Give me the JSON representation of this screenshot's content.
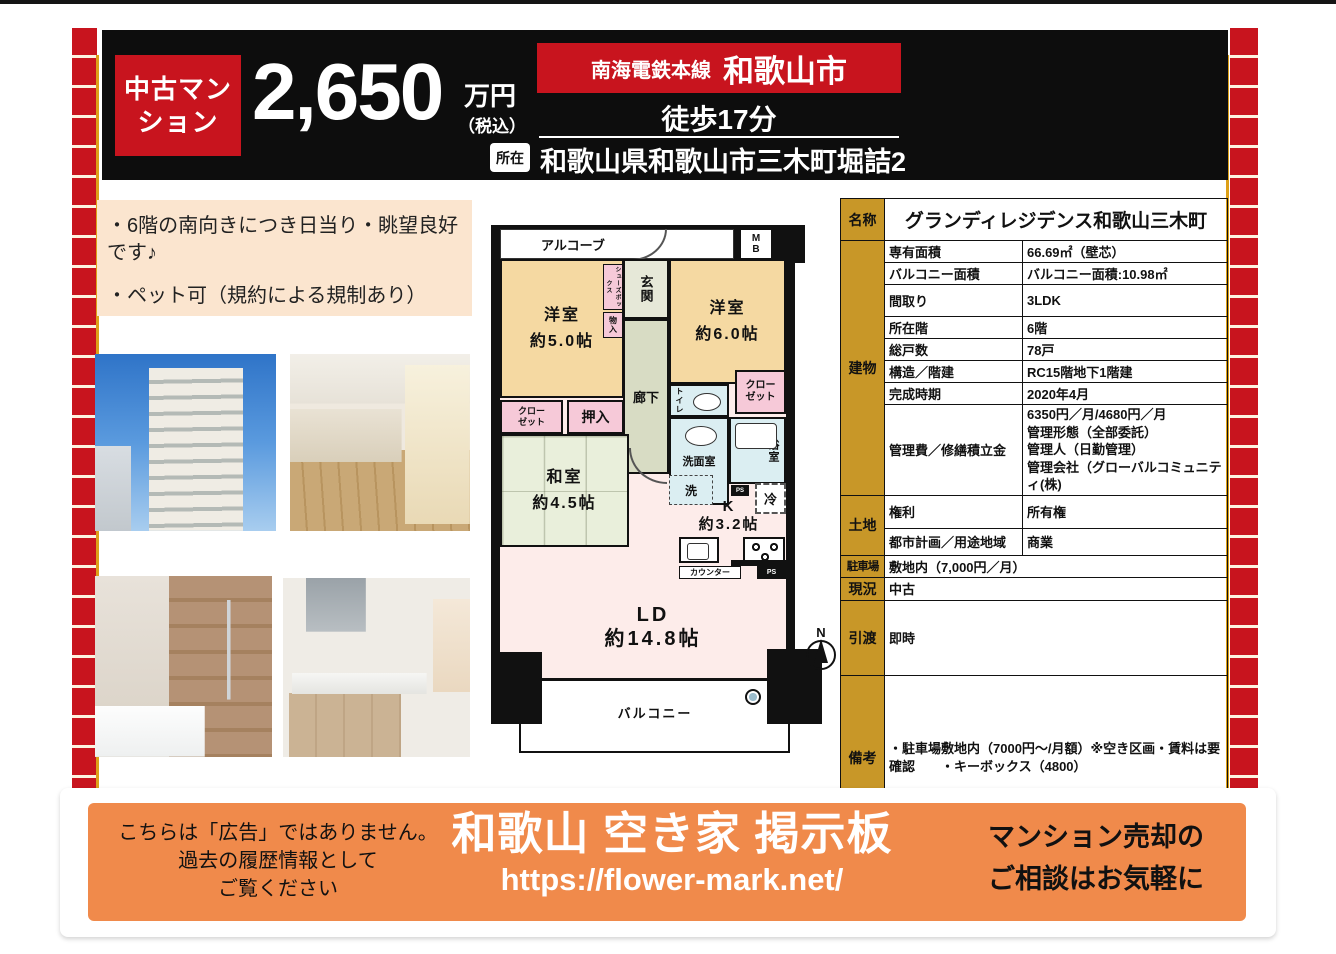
{
  "header": {
    "badge": "中古マン\nション",
    "price": "2,650",
    "price_unit": "万円",
    "price_tax": "（税込）",
    "line_name": "南海電鉄本線",
    "city": "和歌山市",
    "walk": "徒歩17分",
    "location_label": "所在",
    "address": "和歌山県和歌山市三木町堀詰2"
  },
  "description": {
    "line1": "・6階の南向きにつき日当り・眺望良好です♪",
    "line2": "・ペット可（規約による規制あり）"
  },
  "floorplan": {
    "alcove": "アルコーブ",
    "mb": "M\nB",
    "entrance": "玄関",
    "shoes_box": "シューズボックス",
    "storage": "物入",
    "room5": "洋室\n約5.0帖",
    "room6": "洋室\n約6.0帖",
    "hallway": "廊下",
    "toilet": "トイレ",
    "closet": "クロー\nゼット",
    "oshiire": "押入",
    "japanese_room": "和室\n約4.5帖",
    "washroom": "洗面室",
    "wash": "洗",
    "bath": "浴室",
    "ps": "PS",
    "fridge": "冷",
    "kitchen": "K\n約3.2帖",
    "counter": "カウンター",
    "ld": "LD\n約14.8帖",
    "balcony": "バルコニー",
    "north": "N"
  },
  "table": {
    "name_label": "名称",
    "name_value": "グランディレジデンス和歌山三木町",
    "building_label": "建物",
    "building_rows": [
      {
        "label": "専有面積",
        "value": "66.69㎡（壁芯）"
      },
      {
        "label": "バルコニー面積",
        "value": "バルコニー面積:10.98㎡"
      },
      {
        "label": "間取り",
        "value": "3LDK"
      },
      {
        "label": "所在階",
        "value": "6階"
      },
      {
        "label": "総戸数",
        "value": "78戸"
      },
      {
        "label": "構造／階建",
        "value": "RC15階地下1階建"
      },
      {
        "label": "完成時期",
        "value": "2020年4月"
      },
      {
        "label": "管理費／修繕積立金",
        "value": "6350円／月/4680円／月\n管理形態（全部委託）\n管理人（日勤管理）\n管理会社（グローバルコミュニティ(株)"
      }
    ],
    "land_label": "土地",
    "land_rows": [
      {
        "label": "権利",
        "value": "所有権"
      },
      {
        "label": "都市計画／用途地域",
        "value": "商業"
      }
    ],
    "parking_label": "駐車場",
    "parking_value": "敷地内（7,000円／月）",
    "status_label": "現況",
    "status_value": "中古",
    "handover_label": "引渡",
    "handover_value": "即時",
    "notes_label": "備考",
    "notes_value": "・駐車場敷地内（7000円～/月額）※空き区画・賃料は要確認　　・キーボックス（4800）"
  },
  "footer": {
    "disclaimer": "こちらは「広告」ではありません。\n過去の履歴情報として\nご覧ください",
    "site_title": "和歌山 空き家 掲示板",
    "site_url": "https://flower-mark.net/",
    "cta": "マンション売却の\nご相談はお気軽に"
  },
  "colors": {
    "accent_red": "#c8141e",
    "table_gold": "#c89728",
    "footer_orange": "#f08a4b",
    "desc_peach": "#fbe5cf"
  }
}
